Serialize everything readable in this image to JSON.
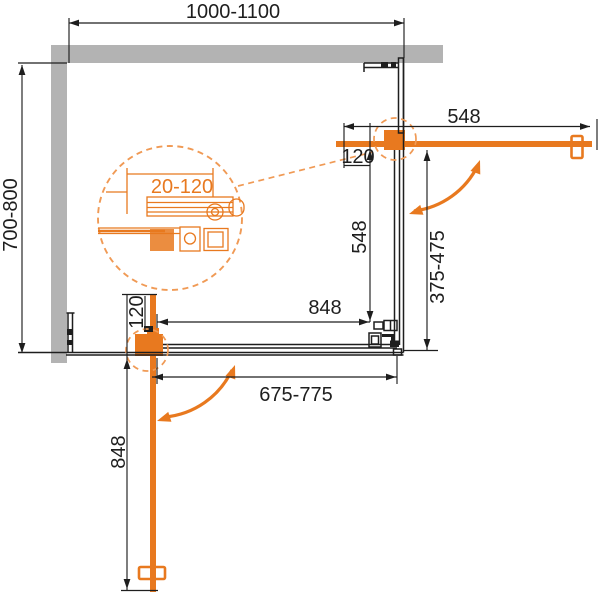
{
  "drawing_labels": {
    "overall_width": "1000-1100",
    "overall_depth": "700-800",
    "right_door_width": "548",
    "right_wall_offset": "120",
    "right_fixed_side": "548",
    "right_entry_range": "375-475",
    "bottom_fixed_side": "848",
    "bottom_entry_range": "675-775",
    "bottom_wall_offset": "120",
    "bottom_door_width": "848",
    "detail_adjustment_range": "20-120"
  },
  "colors": {
    "accent_orange": "#E8791F",
    "accent_orange_light": "#F09A55",
    "wall_gray": "#B3B3B3",
    "line_black": "#1E1E1E"
  }
}
